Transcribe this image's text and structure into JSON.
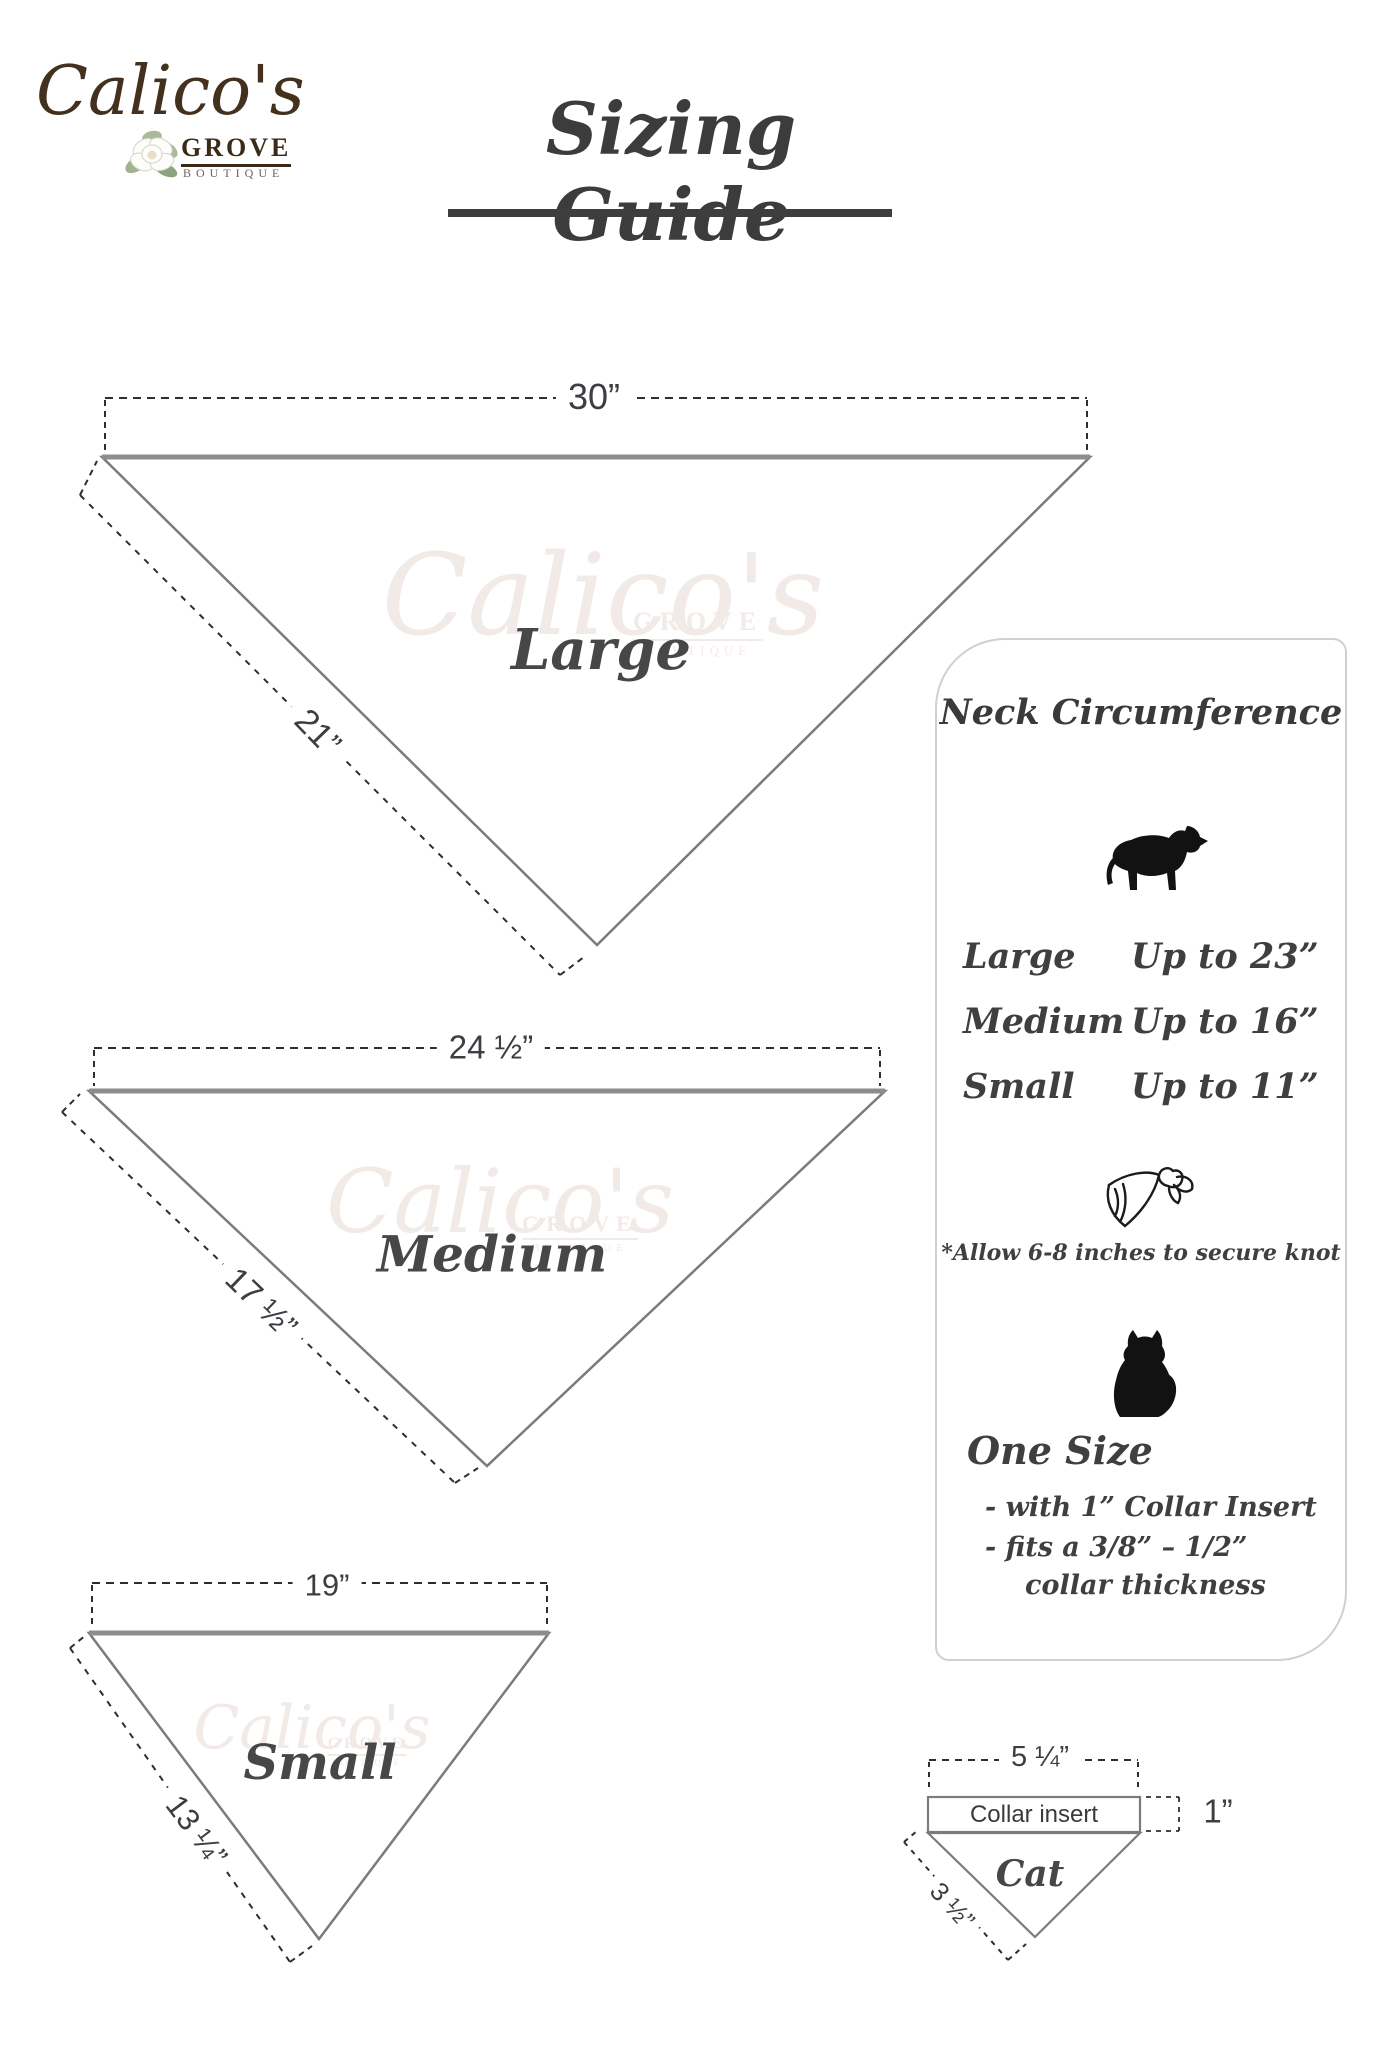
{
  "logo": {
    "name": "Calico's",
    "grove": "GROVE",
    "boutique": "BOUTIQUE"
  },
  "title": "Sizing Guide",
  "watermark": {
    "script": "Calico's",
    "grove": "GROVE",
    "boutique": "BOUTIQUE"
  },
  "diagrams": {
    "large": {
      "name": "Large",
      "top": "30”",
      "side": "21”"
    },
    "medium": {
      "name": "Medium",
      "top": "24 ½”",
      "side": "17 ½”"
    },
    "small": {
      "name": "Small",
      "top": "19”",
      "side": "13 ¼”"
    },
    "cat": {
      "name": "Cat",
      "top": "5 ¼”",
      "side": "3 ½”",
      "insert": "Collar insert",
      "height": "1”"
    }
  },
  "panel": {
    "heading": "Neck Circumference",
    "rows": [
      {
        "size": "Large",
        "value": "Up to 23”"
      },
      {
        "size": "Medium",
        "value": "Up to 16”"
      },
      {
        "size": "Small",
        "value": "Up to 11”"
      }
    ],
    "note": "*Allow 6-8 inches to secure knot",
    "one_size": "One Size",
    "bullets": [
      "- with 1” Collar Insert",
      "- fits a 3/8” – 1/2”",
      "collar thickness"
    ]
  },
  "icons": {
    "dog": "dog-silhouette",
    "bandana": "tied-bandana",
    "cat": "cat-silhouette",
    "flower": "magnolia-flower"
  },
  "colors": {
    "text": "#3f3f3f",
    "solid_line": "#7b7b7b",
    "dash_line": "#2e2e2e",
    "brand_brown": "#43311e",
    "watermark": "#f1eae7",
    "panel_border": "#d2cfcf"
  }
}
